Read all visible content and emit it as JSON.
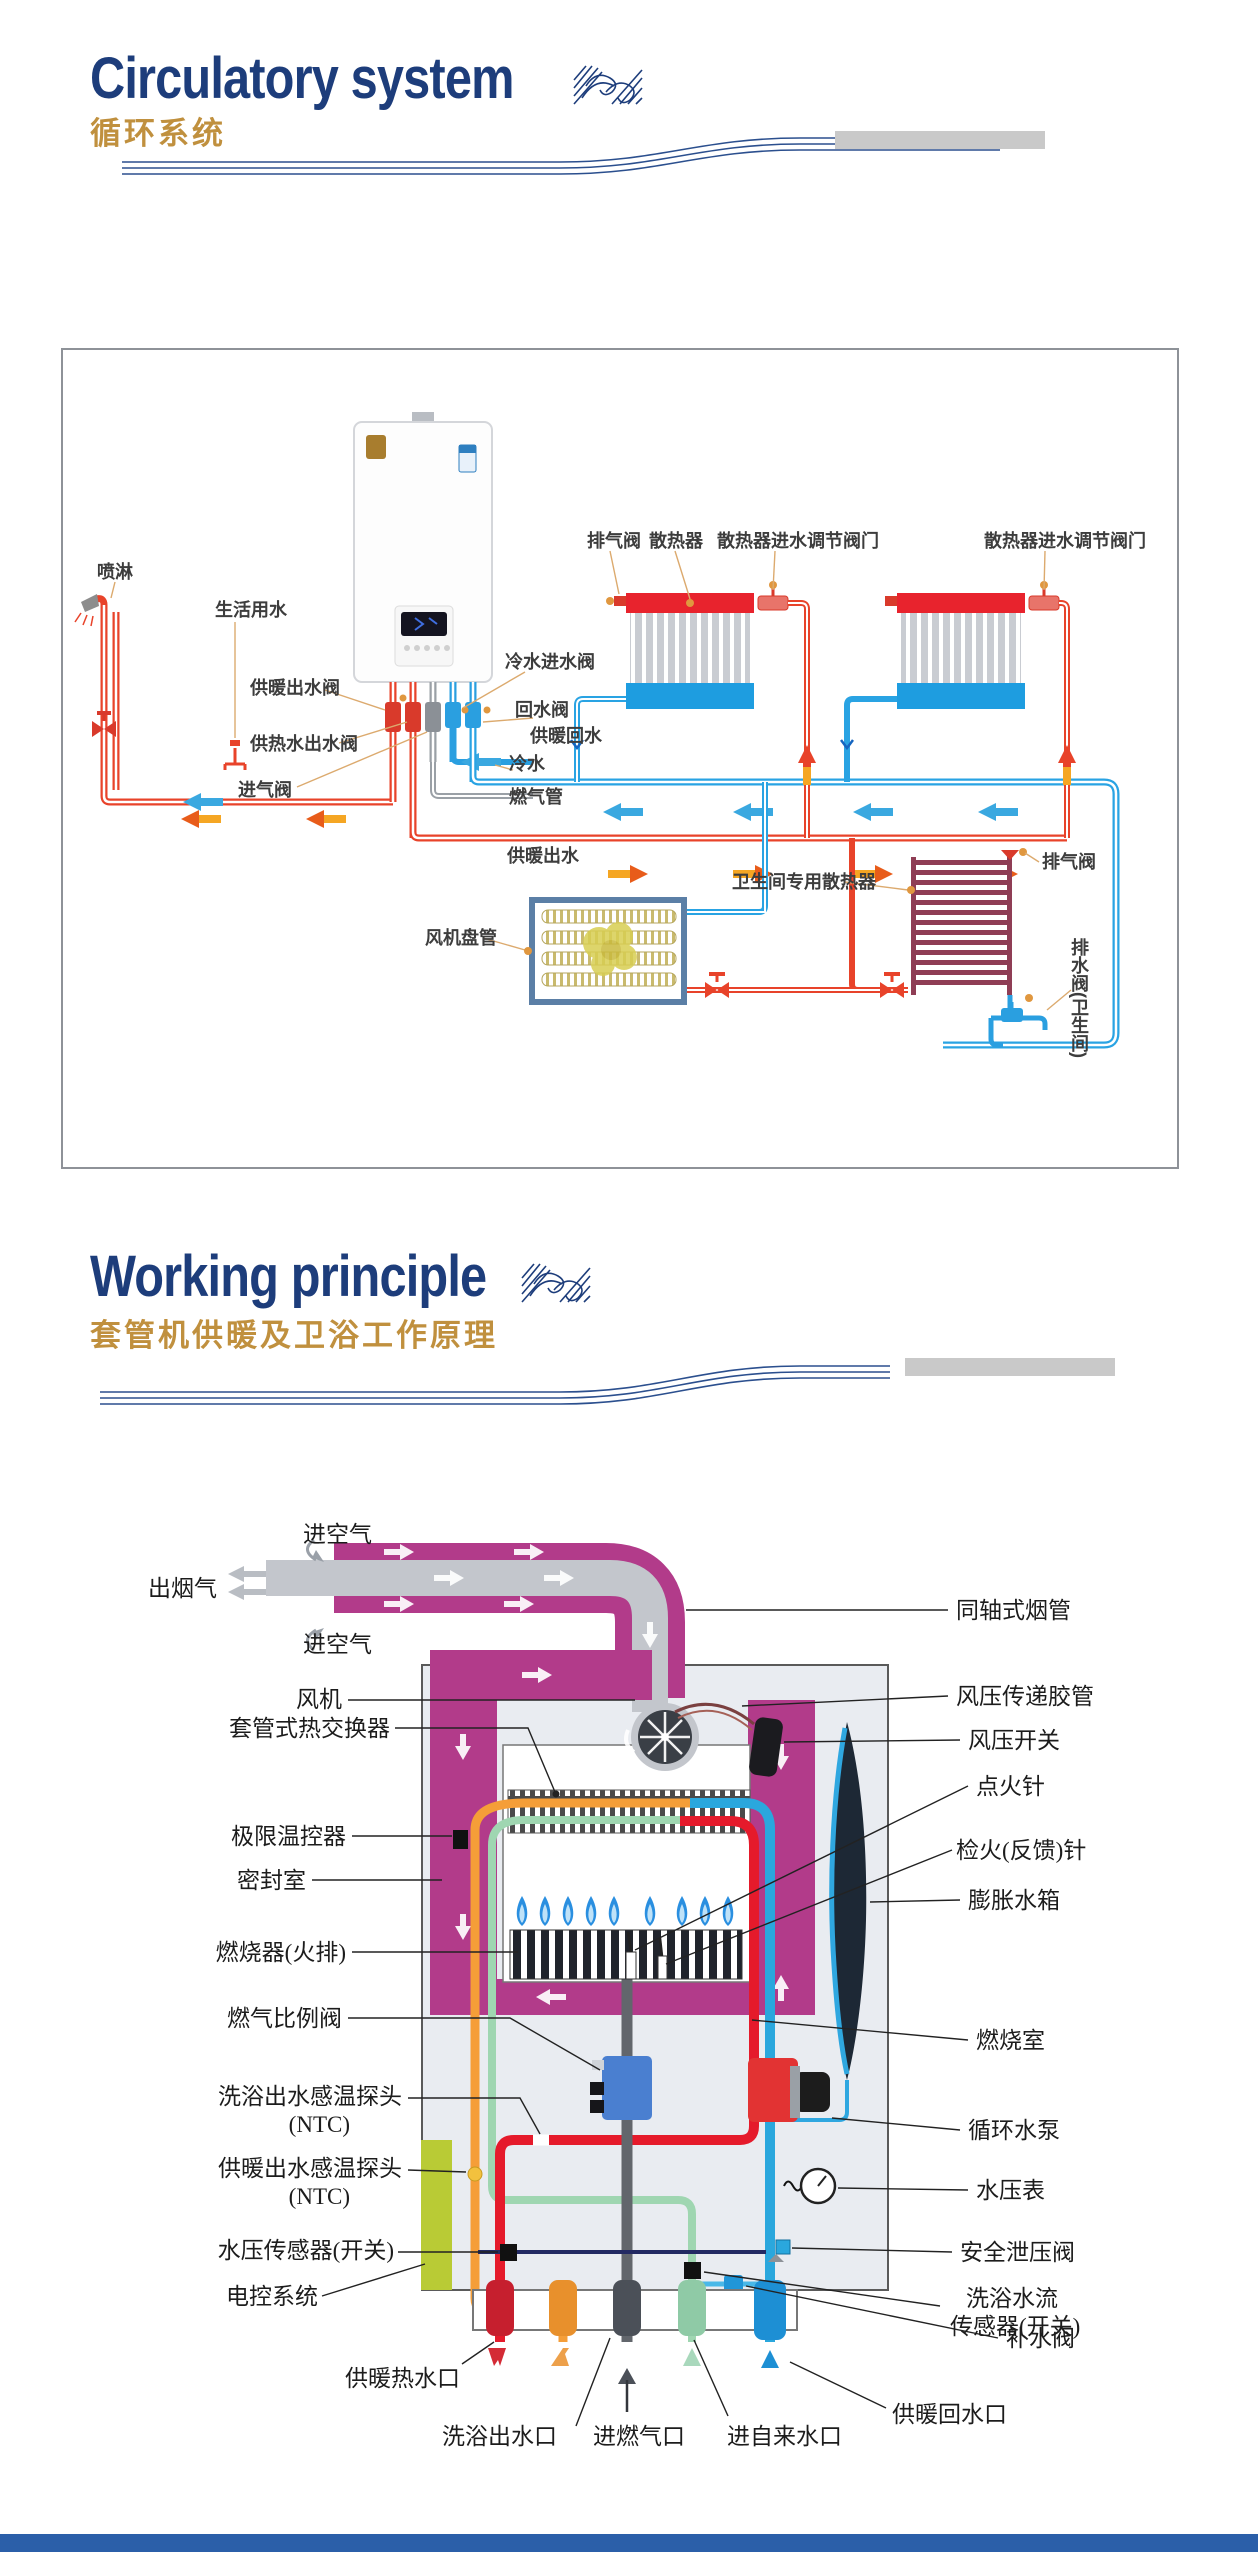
{
  "page": {
    "accent_navy": "#1d3d7b",
    "accent_tan": "#c0903e",
    "magenta": "#b23b8a",
    "bottom_bar_color": "#2b5fa9"
  },
  "section1": {
    "title": "Circulatory system",
    "subtitle": "循环系统"
  },
  "section2": {
    "title": "Working principle",
    "subtitle": "套管机供暖及卫浴工作原理"
  },
  "d1": {
    "labels": [
      {
        "t": "喷淋"
      },
      {
        "t": "生活用水"
      },
      {
        "t": "供暖出水阀"
      },
      {
        "t": "供热水出水阀"
      },
      {
        "t": "进气阀"
      },
      {
        "t": "冷水进水阀"
      },
      {
        "t": "回水阀"
      },
      {
        "t": "供暖回水"
      },
      {
        "t": "冷水"
      },
      {
        "t": "燃气管"
      },
      {
        "t": "供暖出水"
      },
      {
        "t": "排气阀"
      },
      {
        "t": "散热器"
      },
      {
        "t": "散热器进水调节阀门"
      },
      {
        "t": "散热器进水调节阀门"
      },
      {
        "t": "风机盘管"
      },
      {
        "t": "卫生间专用散热器"
      },
      {
        "t": "排气阀"
      },
      {
        "t": "排水阀(卫生间)"
      }
    ]
  },
  "d2": {
    "labels_top": [
      {
        "t": "进空气"
      },
      {
        "t": "出烟气"
      },
      {
        "t": "进空气"
      }
    ],
    "labels_left": [
      {
        "t": "风机"
      },
      {
        "t": "套管式热交换器"
      },
      {
        "t": "极限温控器"
      },
      {
        "t": "密封室"
      },
      {
        "t": "燃烧器(火排)"
      },
      {
        "t": "燃气比例阀"
      },
      {
        "t": "洗浴出水感温探头"
      },
      {
        "t": "(NTC)"
      },
      {
        "t": "供暖出水感温探头"
      },
      {
        "t": "(NTC)"
      },
      {
        "t": "水压传感器(开关)"
      },
      {
        "t": "电控系统"
      }
    ],
    "labels_right": [
      {
        "t": "同轴式烟管"
      },
      {
        "t": "风压传递胶管"
      },
      {
        "t": "风压开关"
      },
      {
        "t": "点火针"
      },
      {
        "t": "检火(反馈)针"
      },
      {
        "t": "膨胀水箱"
      },
      {
        "t": "燃烧室"
      },
      {
        "t": "循环水泵"
      },
      {
        "t": "水压表"
      },
      {
        "t": "安全泄压阀"
      },
      {
        "t": "洗浴水流"
      },
      {
        "t": "传感器(开关)"
      },
      {
        "t": "补水阀"
      },
      {
        "t": "供暖回水口"
      }
    ],
    "labels_bottom": [
      {
        "t": "供暖热水口"
      },
      {
        "t": "洗浴出水口"
      },
      {
        "t": "进燃气口"
      },
      {
        "t": "进自来水口"
      }
    ]
  }
}
